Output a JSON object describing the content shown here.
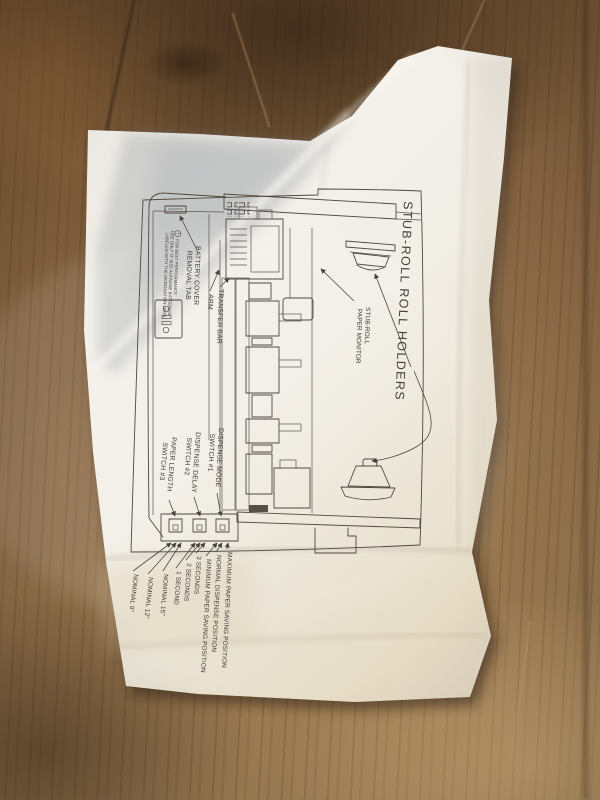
{
  "colors": {
    "ink": "#47423c",
    "paper": "#f1eee7",
    "wood": "#8a6845",
    "wood_dark": "#503a26",
    "wood_light": "#b3936a"
  },
  "diagram": {
    "title": "STUB-ROLL ROLL HOLDERS",
    "battery": {
      "cover_label": [
        "BATTERY COVER",
        "REMOVAL TAB"
      ],
      "warning_lines": [
        "FOR BEST PERFORMANCE",
        "USE ONLY 'D' SIZE ALKALINE BATTERIES",
        "LABELED WITH THE DESIGNATION LR-20"
      ]
    },
    "parts": {
      "transfer_bar": "TRANSFER BAR",
      "arm": "ARM",
      "paper_monitor": [
        "STUB-ROLL",
        "PAPER MONITOR"
      ]
    },
    "switches": [
      {
        "name": [
          "PAPER LENGTH",
          "SWITCH #3"
        ],
        "settings": [
          "NOMINAL 9\"",
          "NOMINAL 12\"",
          "NOMINAL 15\""
        ]
      },
      {
        "name": [
          "DISPENSE DELAY",
          "SWITCH #2"
        ],
        "settings": [
          "1 SECOND",
          "2 SECONDS",
          "3 SECONDS"
        ]
      },
      {
        "name": [
          "DISPENSE MODE",
          "SWITCH #1"
        ],
        "settings": [
          "MINIMUM PAPER SAVING POSITION",
          "NORMAL DISPENSE POSITION",
          "MAXIMUM PAPER SAVING POSITION"
        ]
      }
    ]
  }
}
